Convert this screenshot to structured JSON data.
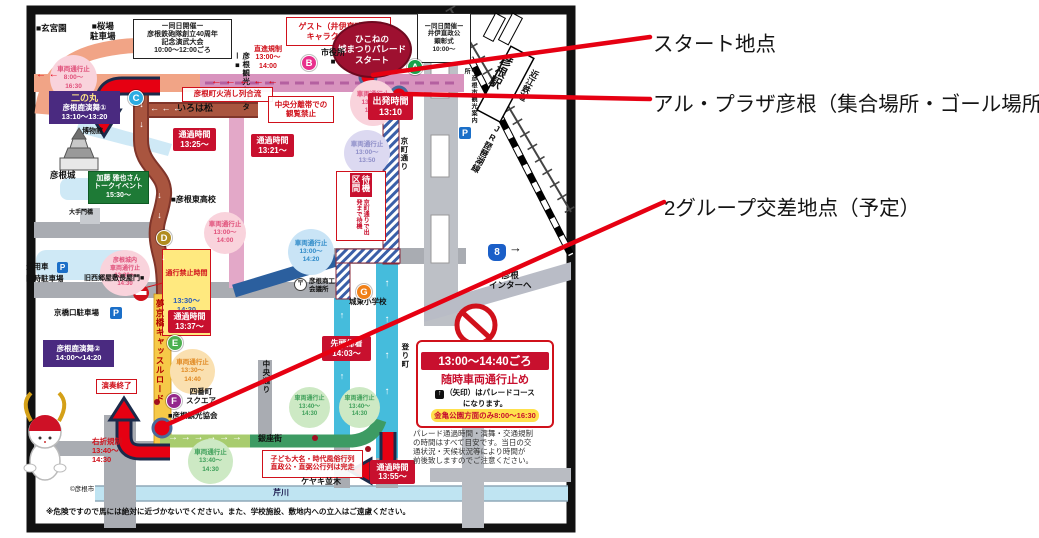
{
  "annotations": {
    "start": "スタート地点",
    "al_plaza": "アル・プラザ彦根（集合場所・ゴール場所）",
    "crossing": "2グループ交差地点（予定）"
  },
  "map": {
    "letters": {
      "a": "A",
      "b": "B",
      "c": "C",
      "d": "D",
      "e": "E",
      "f": "F",
      "g": "G"
    },
    "arrows": {
      "pink_row": "←   ←   ←   ←   ←",
      "salmon_row": "←  ←",
      "iroha_row": "←  ←  ←",
      "down2": "↓\n↓",
      "down1": "↓",
      "up4": "↑\n↑\n↑\n↑",
      "up3": "↑\n↑\n↑",
      "green_row": "→  →  →  →  →  →",
      "right1": "→",
      "up1": "↑"
    },
    "labels": {
      "genkyuen": "■玄宮園",
      "sakuraba": "■桜場\n駐車場",
      "event1": "ー同日開催ー\n彦根鉄砲隊創立40周年\n記念演武大会\n10:00～12:00ごろ",
      "guest": "ゲスト（井伊直政公）\nキャラクター合流",
      "start_ellipse": "ひこねの\n城まつりパレード\nスタート",
      "event2": "ー同日開催ー\n井伊直政公\n顕彰式\n10:00～",
      "chokushin": "直進規制\n13:00～\n14:00",
      "shiyakusho": "市役所\n■",
      "kanko_center": "彦根観光センター■",
      "hikeshi": "彦根町火消し列合流",
      "chuo_bunri": "中央分離帯での\n観覧禁止",
      "irohamatsu": "いろは松",
      "p1": "車両通行止\n8:00～\n16:30",
      "ninomaru_title": "二の丸",
      "ninomaru_body": "彦根鹿演舞①\n13:10～13:20",
      "t1": "通過時間\n13:25～",
      "t2": "通過時間\n13:21～",
      "t3": "出発時間\n13:10",
      "p2": "車両通行止\n13:00～\n13:50",
      "p3": "車両通行止\n13:00～\n13:50",
      "hakubutsukan": "博物館",
      "hikonejo": "彦根城",
      "kato": "加藤 雅也さん\nトークイベント\n15:30～",
      "otemon": "大手門橋",
      "higashi_hs": "■彦根東高校",
      "p4": "車両通行止\n13:00～\n14:00",
      "p5": "車両通行止\n13:00～\n14:20",
      "p6": "彦根城内\n車両通行止\n13:00～\n14:30",
      "w6_title": "通行禁止時間",
      "w6_body": "13:30～\n14:20",
      "joyosha": "乗用車",
      "rinji": "臨時駐車場",
      "saigo": "旧西郷屋敷長屋門■",
      "taiki_strip": "待機区間",
      "taiki_body": "京町通りで出発まで待機",
      "t4": "通過時間\n13:37～",
      "kyobashi_p": "京橋口駐車場",
      "yumekyobashi": "夢京橋キャッスルロード",
      "shoko": "彦根商工\n会議所",
      "post": "〒",
      "joto": "城東小学校",
      "route8": "8",
      "inter": "彦根\nインターへ",
      "noborimachi": "登り町",
      "kyomachi": "京町通り",
      "hikone_sta": "彦根駅",
      "ohmi": "近江鉄道",
      "jr": "JR琵琶湖線",
      "annaisho": "■彦根市観光案内所",
      "p_icon": "P",
      "pb2": "彦根鹿演舞②\n14:00～14:20",
      "ensou": "演奏終了",
      "t5": "先頭帰着\n14:03～",
      "p7": "車両通行止\n13:30～\n14:40",
      "yonbancho": "四番町\nスクエア",
      "chuodori": "中央通り",
      "kankokyokai": "■彦根観光協会",
      "p8": "車両通行止\n13:40～\n14:30",
      "ginzagai": "銀座街",
      "p9": "車両通行止\n13:40～\n14:30",
      "p10": "車両通行止\n13:40～\n14:30",
      "kodomo": "子ども大名・時代風俗行列\n直政公・直弼公行列は完走",
      "keyaki": "ケヤキ並木",
      "serikawa": "芹川",
      "t6": "通過時間\n13:55～",
      "usetsu": "右折規制\n13:40～\n14:30",
      "copyright": "©彦根市",
      "caution": "※危険ですので馬には絶対に近づかないでください。また、学校施設、敷地内への立入はご遠慮ください。",
      "warn_band1": "13:00～14:40ごろ",
      "warn_l2": "随時車両通行止め",
      "warn_arrow": "↑",
      "warn_l3": "（矢印）はパレードコース\nになります。",
      "warn_band2": "金亀公園方面のみ8:00～16:30",
      "note": "パレード通過時間・演舞・交通規制\nの時間はすべて目安です。当日の交\n通状況・天候状況等により時間が\n前後致しますのでご注意ください。"
    },
    "colors": {
      "leader_red": "#E60012",
      "route_brown": "#A9553F",
      "route_cyan": "#45BCDC",
      "route_green": "#3D9B63",
      "road_yellow": "#F6C948",
      "road_pink": "#D893BE"
    }
  }
}
